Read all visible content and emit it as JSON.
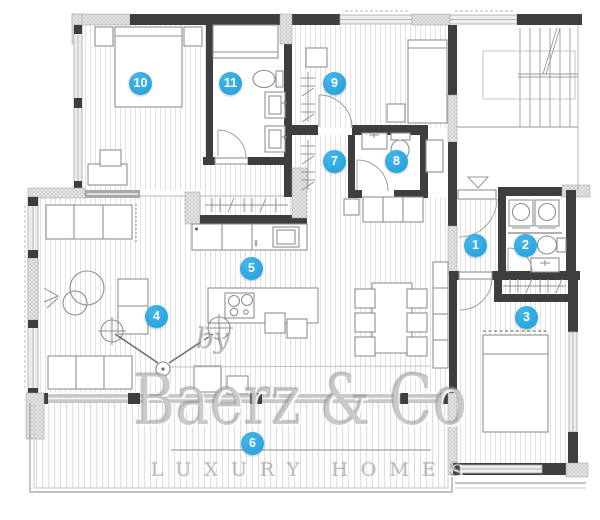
{
  "plan": {
    "type": "apartment-floor-plan",
    "room_markers": [
      {
        "number": "1"
      },
      {
        "number": "2"
      },
      {
        "number": "3"
      },
      {
        "number": "4"
      },
      {
        "number": "5"
      },
      {
        "number": "6"
      },
      {
        "number": "7"
      },
      {
        "number": "8"
      },
      {
        "number": "9"
      },
      {
        "number": "10"
      },
      {
        "number": "11"
      }
    ],
    "palette": {
      "wall_dark": "#3e3e3e",
      "wall_hatch": "#cccccc",
      "floor_line": "#e3e3e3",
      "furniture_line": "#8f8f8f",
      "marker_blue": "#29a7e0",
      "watermark_gray": "#9a9a9a"
    }
  },
  "watermark": {
    "brand": "Baerz & Co",
    "by": "by",
    "tagline": "LUXURY HOMES"
  }
}
